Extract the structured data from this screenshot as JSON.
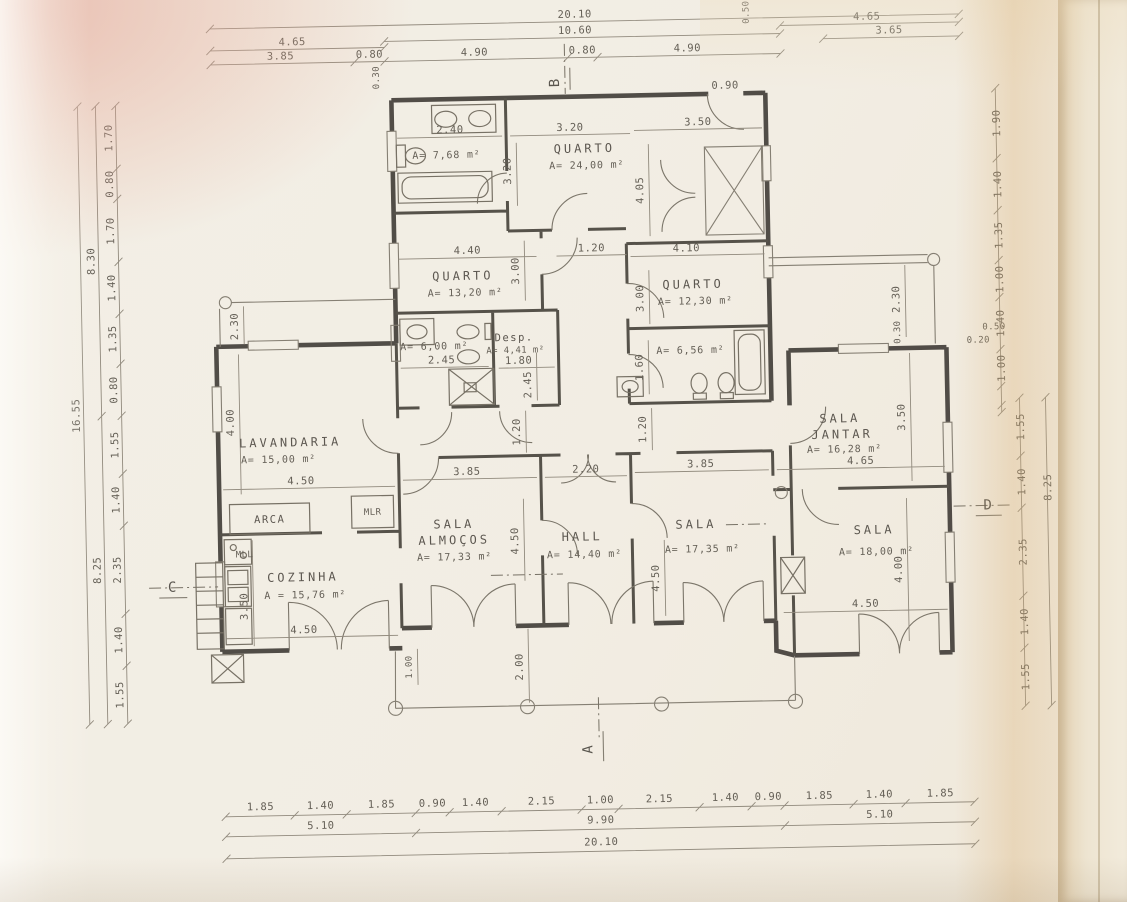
{
  "d": {
    "rooms": {
      "bath_top": {
        "area": "A= 7,68 m²"
      },
      "quarto_main": {
        "name": "QUARTO",
        "area": "A= 24,00 m²"
      },
      "quarto_mid": {
        "name": "QUARTO",
        "area": "A= 13,20 m²"
      },
      "quarto_right": {
        "name": "QUARTO",
        "area": "A= 12,30 m²"
      },
      "bath_mid": {
        "area": "A= 6,00 m²"
      },
      "despensa": {
        "name": "Desp.",
        "area": "A= 4,41 m²"
      },
      "bath_right": {
        "area": "A= 6,56 m²"
      },
      "lavandaria": {
        "name": "LAVANDARIA",
        "area": "A= 15,00 m²"
      },
      "cozinha": {
        "name": "COZINHA",
        "area": "A = 15,76 m²"
      },
      "sala_almocos": {
        "name1": "SALA",
        "name2": "ALMOÇOS",
        "area": "A= 17,33 m²"
      },
      "hall": {
        "name": "HALL",
        "area": "A= 14,40 m²"
      },
      "sala_center": {
        "name": "SALA",
        "area": "A= 17,35 m²"
      },
      "sala_jantar": {
        "name1": "SALA",
        "name2": "JANTAR",
        "area": "A= 16,28 m²"
      },
      "sala_right": {
        "name": "SALA",
        "area": "A= 18,00 m²"
      }
    },
    "equip": {
      "arca": "ARCA",
      "mlr": "MLR",
      "mll": "MLL"
    },
    "marks": {
      "a": "A",
      "b": "B",
      "c": "C",
      "d": "D"
    },
    "dims": {
      "top": {
        "total": "20.10",
        "wing": "10.60",
        "pair": "4.65",
        "row": [
          "3.85",
          "0.80",
          "4.90",
          "0.80",
          "4.90"
        ],
        "offset": "0.30",
        "b_off": "0.50",
        "r1": "4.65",
        "r2": "3.65"
      },
      "bottom": {
        "row": [
          "1.85",
          "1.40",
          "1.85",
          "0.90",
          "1.40",
          "2.15",
          "1.00",
          "2.15",
          "1.40",
          "0.90",
          "1.85",
          "1.40",
          "1.85"
        ],
        "mid": [
          "5.10",
          "9.90",
          "5.10"
        ],
        "total": "20.10"
      },
      "left": {
        "up": [
          "1.70",
          "0.80",
          "1.70",
          "1.40",
          "1.35",
          "0.80"
        ],
        "up_total": "8.30",
        "low": [
          "1.55",
          "1.40",
          "2.35",
          "1.40",
          "1.55"
        ],
        "low_total": "8.25",
        "total": "16.55"
      },
      "right": {
        "up": [
          "1.90",
          "1.40",
          "1.35",
          "1.00",
          "1.40",
          "1.00"
        ],
        "off1": "0.50",
        "off2": "0.20",
        "low": [
          "1.55",
          "1.40",
          "2.35",
          "1.40",
          "1.55"
        ],
        "low_total": "8.25"
      },
      "in": {
        "bath_top_w": "2.40",
        "qm_w": "3.20",
        "qm_h": "3.20",
        "cl_w": "3.50",
        "cl_door": "0.90",
        "qm_d": "4.05",
        "q2_w": "4.40",
        "q2_h": "3.00",
        "corr1": "1.20",
        "q3_w": "4.10",
        "q3_h": "3.00",
        "bm_w": "2.45",
        "desp_w": "1.80",
        "desp_h": "2.45",
        "br_h": "1.60",
        "patio": "2.30",
        "lav_h": "4.00",
        "lav_w": "4.50",
        "coz_h": "3.50",
        "coz_w": "4.50",
        "alm_w": "3.85",
        "hall_w": "2.20",
        "sala_w": "3.85",
        "alm_h": "4.50",
        "sala_h": "4.50",
        "corr_l": "1.20",
        "corr_r": "1.20",
        "jan_w": "4.65",
        "jan_h": "3.50",
        "st1": "2.30",
        "st2": "0.30",
        "sr_w": "4.50",
        "sr_h": "4.00",
        "po1": "1.00",
        "po2": "2.00"
      }
    }
  }
}
